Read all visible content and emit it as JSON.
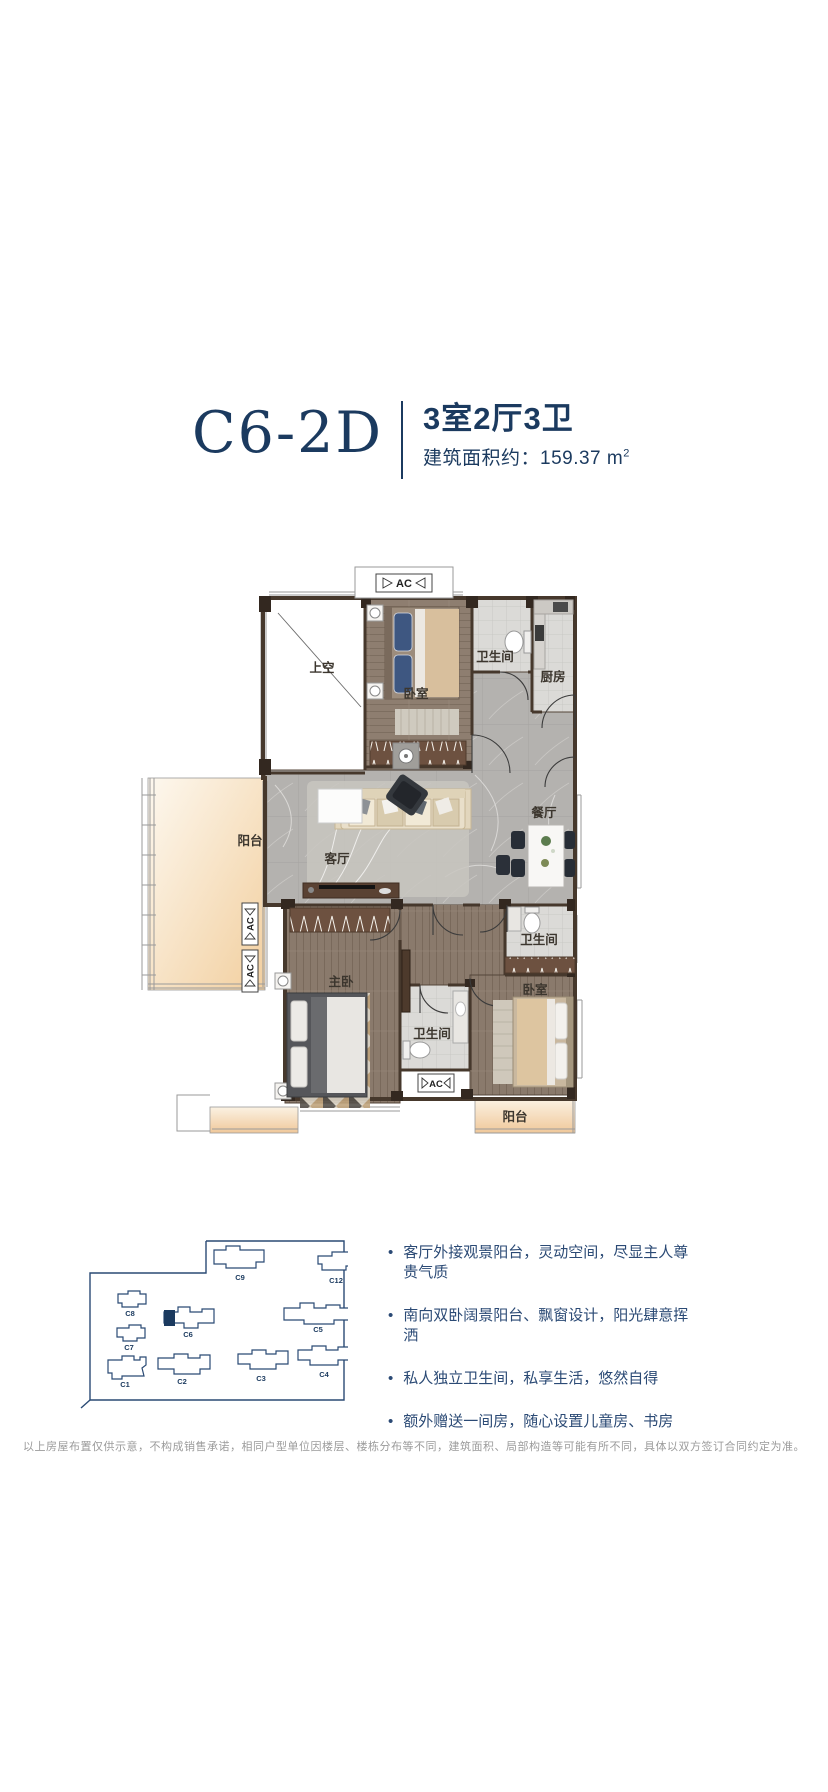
{
  "header": {
    "plan_code": "C6-2D",
    "layout_spec": "3室2厅3卫",
    "area_text": "建筑面积约：159.37 m",
    "area_sup": "2"
  },
  "floorplan": {
    "labels": {
      "void": "上空",
      "bedroom_top": "卧室",
      "bath_top": "卫生间",
      "kitchen": "厨房",
      "living": "客厅",
      "dining": "餐厅",
      "balcony_left": "阳台",
      "master": "主卧",
      "bath_mid": "卫生间",
      "bedroom_bottom": "卧室",
      "bath_bottom": "卫生间",
      "balcony_bottom": "阳台",
      "ac": "AC"
    }
  },
  "siteplan": {
    "buildings": [
      {
        "label": "C9"
      },
      {
        "label": "C12"
      },
      {
        "label": "C8"
      },
      {
        "label": "C6",
        "highlighted": true
      },
      {
        "label": "C5"
      },
      {
        "label": "C7"
      },
      {
        "label": "C1"
      },
      {
        "label": "C2"
      },
      {
        "label": "C3"
      },
      {
        "label": "C4"
      }
    ]
  },
  "features": {
    "bullet": "•",
    "items": [
      "客厅外接观景阳台，灵动空间，尽显主人尊贵气质",
      "南向双卧阔景阳台、飘窗设计，阳光肆意挥洒",
      "私人独立卫生间，私享生活，悠然自得",
      "额外赠送一间房，随心设置儿童房、书房"
    ]
  },
  "disclaimer": "以上房屋布置仅供示意，不构成销售承诺，相同户型单位因楼层、楼栋分布等不同，建筑面积、局部构造等可能有所不同，具体以双方签订合同约定为准。",
  "colors": {
    "navy": "#1b3a5f",
    "bullet_text": "#2b4a75",
    "siteplan_line": "#2a4a74",
    "wall": "#46382c"
  }
}
